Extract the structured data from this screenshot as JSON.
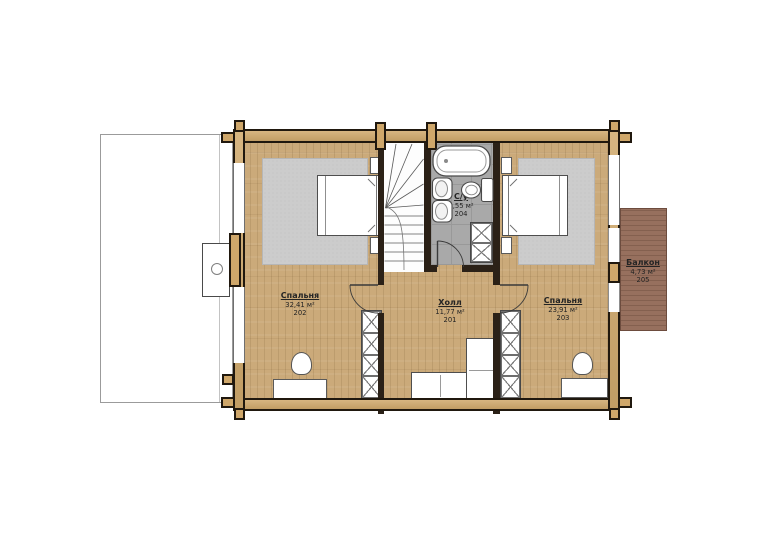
{
  "floorplan": {
    "plan_title": "Second floor plan",
    "rooms": [
      {
        "key": "bedroom-left",
        "name": "Спальня",
        "area": "32,41 м²",
        "number": "202"
      },
      {
        "key": "hall",
        "name": "Холл",
        "area": "11,77 м²",
        "number": "201"
      },
      {
        "key": "bedroom-right",
        "name": "Спальня",
        "area": "23,91 м²",
        "number": "203"
      },
      {
        "key": "bathroom",
        "name": "С/у",
        "area": "6,55 м²",
        "number": "204"
      },
      {
        "key": "balcony",
        "name": "Балкон",
        "area": "4,73 м²",
        "number": "205"
      }
    ],
    "colors": {
      "wall_wood": "#d0a96c",
      "floor_wood": "#cbaa7a",
      "bathroom_tile": "#a9a9a9",
      "rug": "#cccccc",
      "balcony_deck": "#97705e",
      "outline": "#20180e"
    }
  }
}
